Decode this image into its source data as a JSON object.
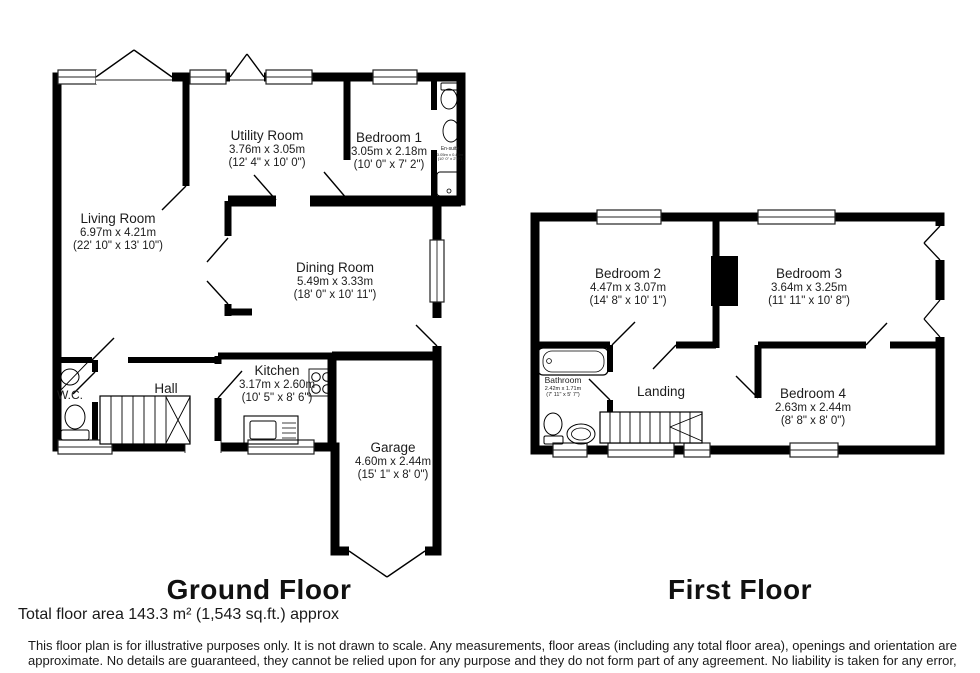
{
  "page": {
    "background": "#ffffff",
    "line_color": "#000000"
  },
  "ground_floor": {
    "title": "Ground Floor",
    "rooms": {
      "living_room": {
        "name": "Living Room",
        "metric": "6.97m x 4.21m",
        "imperial": "(22' 10\" x 13' 10\")"
      },
      "utility_room": {
        "name": "Utility Room",
        "metric": "3.76m x 3.05m",
        "imperial": "(12' 4\" x 10' 0\")"
      },
      "bedroom_1": {
        "name": "Bedroom 1",
        "metric": "3.05m x 2.18m",
        "imperial": "(10' 0\" x 7' 2\")"
      },
      "en_suite": {
        "name": "En-suite",
        "metric": "3.05m x 0.84m",
        "imperial": "(10' 0\" x 2' 9\")"
      },
      "dining_room": {
        "name": "Dining Room",
        "metric": "5.49m x 3.33m",
        "imperial": "(18' 0\" x 10' 11\")"
      },
      "kitchen": {
        "name": "Kitchen",
        "metric": "3.17m x 2.60m",
        "imperial": "(10' 5\" x 8' 6\")"
      },
      "hall": {
        "name": "Hall"
      },
      "wc": {
        "name": "W.C."
      },
      "garage": {
        "name": "Garage",
        "metric": "4.60m x 2.44m",
        "imperial": "(15' 1\" x 8' 0\")"
      }
    }
  },
  "first_floor": {
    "title": "First Floor",
    "rooms": {
      "bedroom_2": {
        "name": "Bedroom 2",
        "metric": "4.47m x 3.07m",
        "imperial": "(14' 8\" x 10' 1\")"
      },
      "bedroom_3": {
        "name": "Bedroom 3",
        "metric": "3.64m x 3.25m",
        "imperial": "(11' 11\" x 10' 8\")"
      },
      "bedroom_4": {
        "name": "Bedroom 4",
        "metric": "2.63m x 2.44m",
        "imperial": "(8' 8\" x 8' 0\")"
      },
      "bathroom": {
        "name": "Bathroom",
        "metric": "2.42m x 1.71m",
        "imperial": "(7' 11\" x 5' 7\")"
      },
      "landing": {
        "name": "Landing"
      }
    }
  },
  "footer": {
    "total_area": "Total floor area 143.3 m² (1,543 sq.ft.) approx",
    "disclaimer_line1": "This floor plan is for illustrative purposes only. It is not drawn to scale. Any measurements, floor areas (including any total floor area), openings and orientation are",
    "disclaimer_line2": "approximate. No details are guaranteed, they cannot be relied upon for any purpose and they do not form part of any agreement. No liability is taken for any error,"
  }
}
